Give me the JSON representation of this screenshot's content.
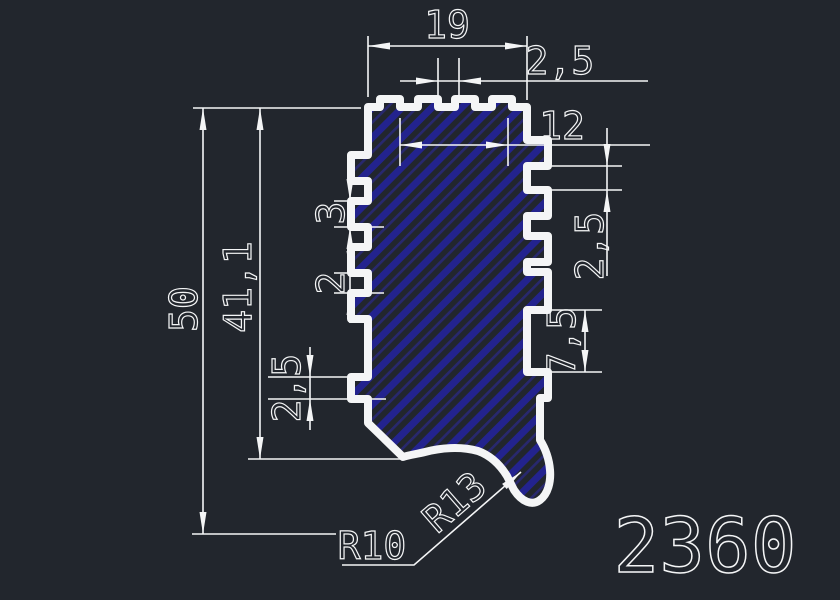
{
  "colors": {
    "background": "#22262d",
    "line": "#f4f5f6",
    "hatch_primary": "#23238e",
    "hatch_secondary": "#28286e"
  },
  "drawing": {
    "part_number": "2360",
    "dims": {
      "top_width": "19",
      "top_notch": "2,5",
      "inner_width": "12",
      "left_tooth": "3",
      "left_gap": "2",
      "left_bottom_tooth": "2,5",
      "overall_height": "50",
      "body_height": "41,1",
      "right_gap": "2,5",
      "right_plain": "7,5",
      "radius_inner": "R10",
      "radius_outer": "R13"
    }
  }
}
